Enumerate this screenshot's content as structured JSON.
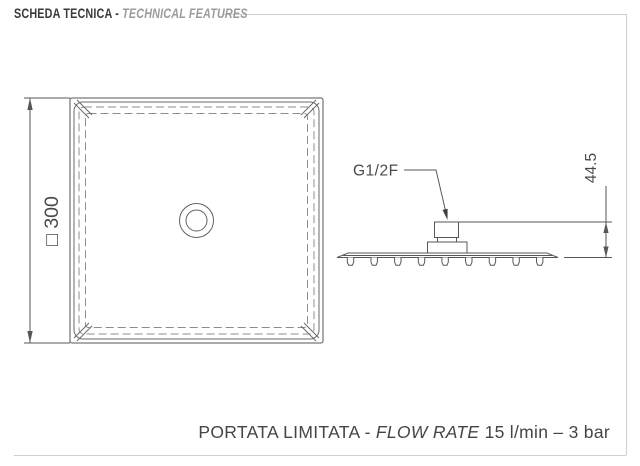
{
  "header": {
    "title_it": "SCHEDA TECNICA - ",
    "title_en": "TECHNICAL FEATURES"
  },
  "drawing": {
    "top_view": {
      "dimension_label": "□ 300"
    },
    "side_view": {
      "connection_label": "G1/2F",
      "height_dimension": "44.5"
    }
  },
  "footer": {
    "part_it": "PORTATA LIMITATA - ",
    "part_en": "FLOW RATE",
    "part_value": " 15 l/min – 3 bar"
  },
  "colors": {
    "line": "#575757",
    "dashed_line": "#8c8c8c",
    "frame": "#cfcfcf",
    "title_dark": "#3a3a3a",
    "title_gray": "#9b9b9b",
    "text": "#4a4a4a"
  }
}
